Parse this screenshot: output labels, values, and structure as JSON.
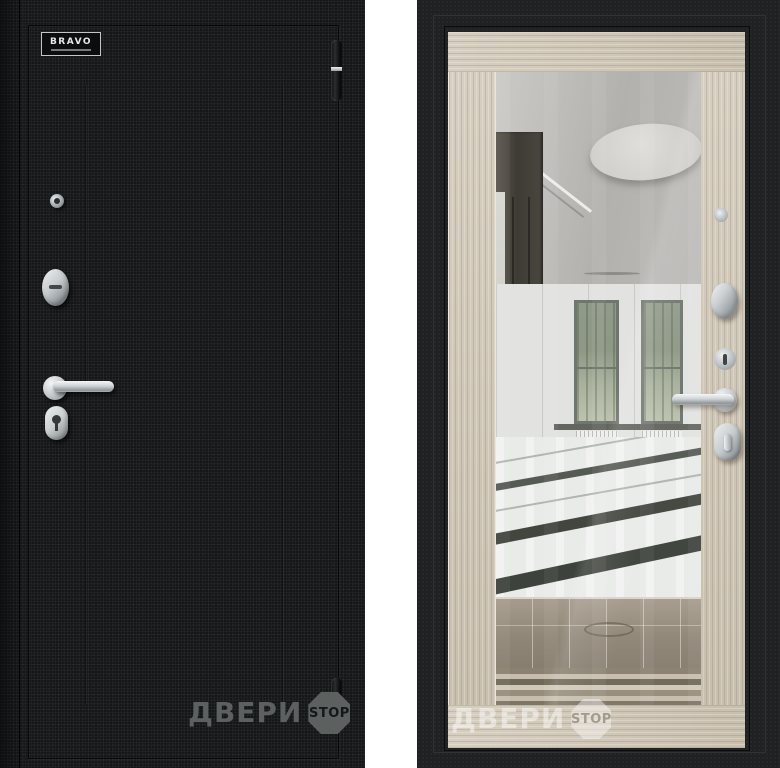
{
  "left_door": {
    "logo_text": "BRAVO",
    "watermark_text": "ДВЕРИ",
    "watermark_stop_text": "STOP"
  },
  "right_door": {
    "watermark_text": "ДВЕРИ",
    "watermark_stop_text": "STOP"
  },
  "colors": {
    "page_background": "#ffffff",
    "door_exterior_black": "#141617",
    "door_frame_black": "#1f2123",
    "wood_trim": "#cfc6b6",
    "chrome_hardware": "#c6cbce",
    "watermark_gray": "#5c6160",
    "watermark_white": "rgba(255,255,255,0.48)"
  }
}
